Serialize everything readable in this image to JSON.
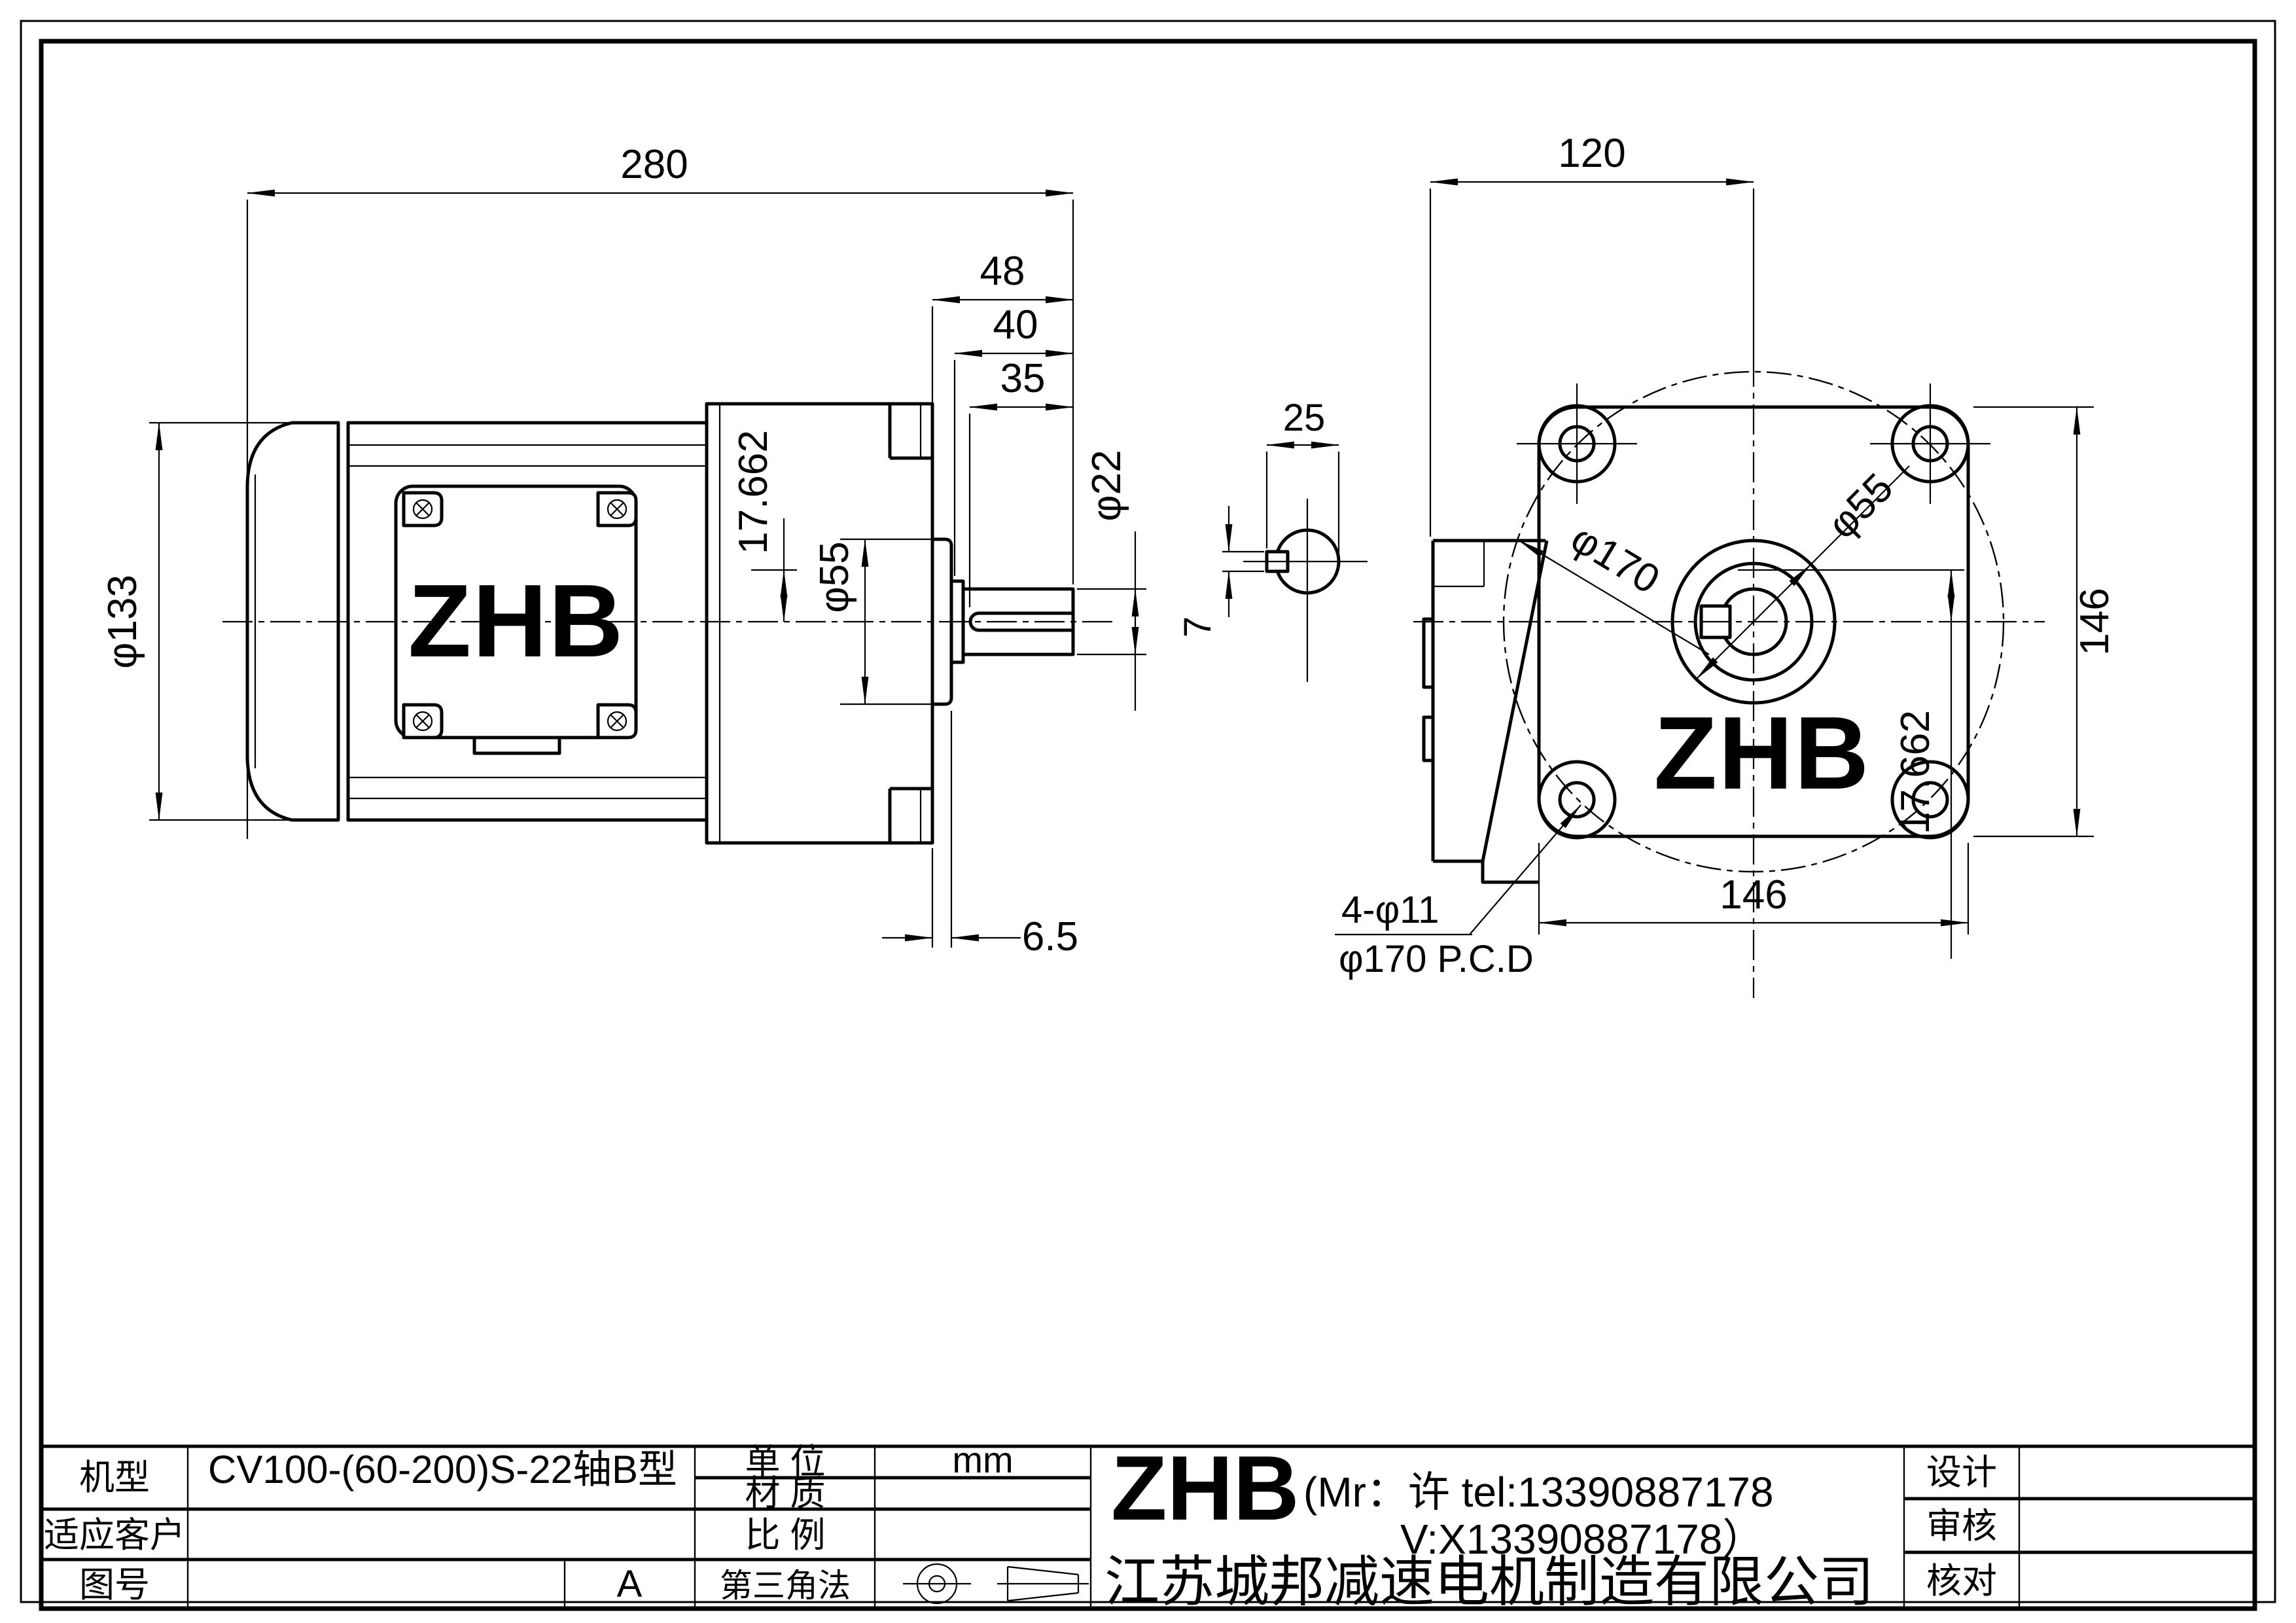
{
  "drawing": {
    "brand": "ZHB",
    "left_view": {
      "logo": "ZHB",
      "dim_overall": "280",
      "dim_shaft_total": "48",
      "dim_shaft_usable": "40",
      "dim_key_length": "35",
      "dim_shaft_dia": "φ22",
      "dim_key_height": "17.662",
      "dim_spigot_dia": "φ55",
      "dim_motor_dia": "φ133",
      "dim_plate_offset": "6.5"
    },
    "front_view": {
      "logo": "ZHB",
      "dim_box_to_axis": "120",
      "dim_key_section_w": "25",
      "dim_key_section_h": "7",
      "dim_bolt_circle": "φ170",
      "dim_spigot_dia": "φ55",
      "dim_flange_height": "146",
      "dim_key_height": "17.662",
      "dim_flange_width": "146",
      "holes_label": "4-φ11",
      "pcd_label": "φ170 P.C.D"
    }
  },
  "title_block": {
    "model_label": "机型",
    "model_value": "CV100-(60-200)S-22轴B型",
    "customer_label": "适应客户",
    "customer_value": "",
    "drawing_no_label": "图号",
    "drawing_no_value": "",
    "revision": "A",
    "unit_label": "单  位",
    "unit_value": "mm",
    "material_label": "材  质",
    "material_value": "",
    "scale_label": "比  例",
    "scale_value": "",
    "projection_label": "第三角法",
    "company_brand": "ZHB",
    "company_contact_line1": "(Mr：许 tel:13390887178",
    "company_contact_line2": "V:X13390887178）",
    "company_name": "江苏城邦减速电机制造有限公司",
    "design_label": "设计",
    "audit_label": "审核",
    "check_label": "核对"
  }
}
